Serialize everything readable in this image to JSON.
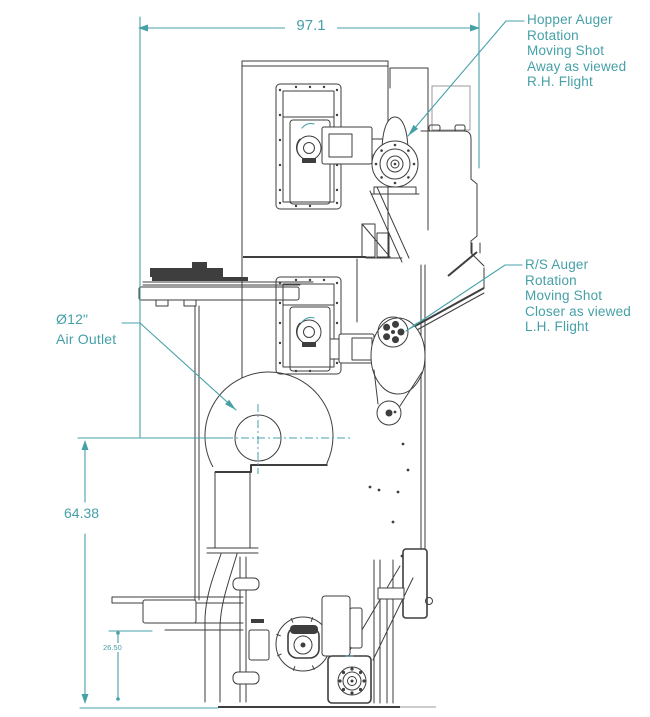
{
  "colors": {
    "annotation": "#45a0a8",
    "drawing_line": "#3e3e3e",
    "background": "#ffffff"
  },
  "dimensions": {
    "overall_width": "97.1",
    "outlet_centerline_height": "64.38",
    "base_height": "26.50"
  },
  "callouts": {
    "hopper_auger": {
      "lines": [
        "Hopper Auger",
        "Rotation",
        "Moving Shot",
        "Away as viewed",
        "R.H. Flight"
      ]
    },
    "rs_auger": {
      "lines": [
        "R/S Auger",
        "Rotation",
        "Moving Shot",
        "Closer as viewed",
        "L.H. Flight"
      ]
    },
    "air_outlet": {
      "lines": [
        "Ø12\"",
        "Air Outlet"
      ]
    }
  }
}
